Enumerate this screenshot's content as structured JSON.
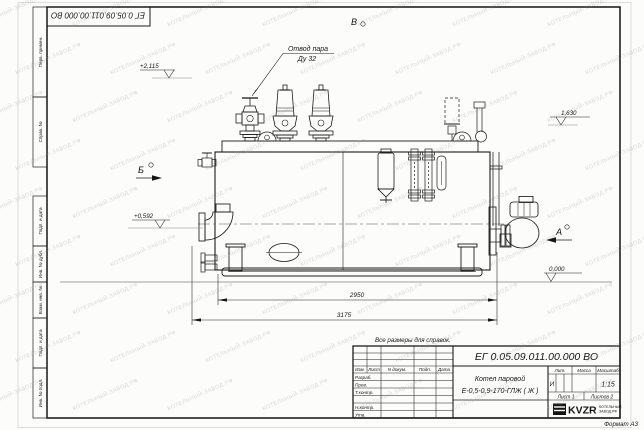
{
  "sheet": {
    "designation": "ЕГ 0.05.09.011.00.000  ВО",
    "note_above_title": "Все размеры для справок.",
    "format": "Формат А3"
  },
  "annotations": {
    "steam_outlet": {
      "line1": "Отвод пара",
      "line2": "Ду 32"
    },
    "views": {
      "a": "А",
      "b": "Б",
      "v": "В"
    },
    "elevations": {
      "top": "+2,115",
      "right": "1,630",
      "left": "+0,592",
      "zero": "0,000"
    },
    "dimensions": {
      "inner": "2950",
      "overall": "3175"
    }
  },
  "title_block": {
    "doc_number": "ЕГ 0.05.09.011.00.000  ВО",
    "product_name_line1": "Котел паровой",
    "product_name_line2": "Е-0,5-0,9-170-ГЛЖ ( Ж )",
    "col_izm": "Изм.",
    "col_list": "Лист",
    "col_doc": "N докум.",
    "col_podp": "Подп.",
    "col_data": "Дата",
    "row_razrab": "Разраб.",
    "row_prov": "Пров.",
    "row_tkontr": "Т.контр.",
    "row_nkontr": "Н.контр.",
    "row_utv": "Утв.",
    "lit_header": "Лит.",
    "mass_header": "Масса",
    "scale_header": "Масштаб",
    "lit_value": "И",
    "scale_value": "1:15",
    "sheet": "Лист 1",
    "sheets": "Листов 2",
    "logo": "KVZR",
    "logo_sub1": "КОТЕЛЬНЫЙ",
    "logo_sub2": "ЗАВОД.РФ"
  },
  "margin": {
    "c1": "Перв. примен.",
    "c2": "Справ. №",
    "c3": "Подп. и дата",
    "c4": "Инв. № дубл.",
    "c5": "Взам. инв. №",
    "c6": "Подп. и дата",
    "c7": "Инв. № подл."
  },
  "watermark": {
    "text": "КОТЕЛЬНЫЙ-ЗАВОД.РФ"
  }
}
